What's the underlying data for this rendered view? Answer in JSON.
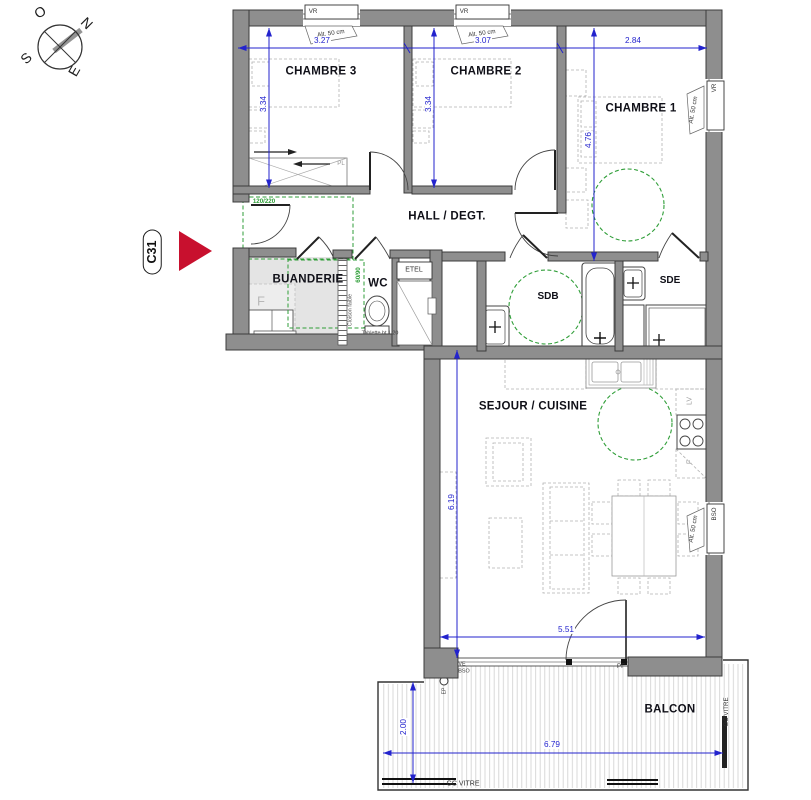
{
  "unit": {
    "label": "C31"
  },
  "compass": {
    "o": "O",
    "n": "N",
    "e": "E",
    "s": "S"
  },
  "rooms": {
    "chambre3": "CHAMBRE 3",
    "chambre2": "CHAMBRE 2",
    "chambre1": "CHAMBRE 1",
    "hall": "HALL / DEGT.",
    "buanderie": "BUANDERIE",
    "wc": "WC",
    "sdb": "SDB",
    "sde": "SDE",
    "sejour": "SEJOUR / CUISINE",
    "balcon": "BALCON"
  },
  "dimensions": {
    "chambre3_width": "3.27",
    "chambre2_width": "3.07",
    "chambre1_width": "2.84",
    "chambre3_depth": "3.34",
    "chambre2_depth": "3.34",
    "chambre1_depth": "4.76",
    "sejour_depth": "6.19",
    "sejour_width": "5.51",
    "balcon_depth": "2.00",
    "balcon_width": "6.79"
  },
  "openings": {
    "vr": "VR",
    "bso": "BSO",
    "alt_50": "Alt. 50 cm",
    "entry_door_size": "120/220",
    "wc_door_size": "60/90",
    "ve": "VE",
    "pf": "PF",
    "ep": "EP",
    "gc_vitre": "GC VITRE"
  },
  "annotations": {
    "pl": "PL",
    "etel": "ETEL",
    "cloison_faible": "Cloison faible",
    "tablette": "Tablette ht 1.20",
    "washer": "F",
    "lv": "LV",
    "oven": "F"
  },
  "colors": {
    "dimension_blue": "#2323cd",
    "clearance_green": "#2f9e38",
    "arrow_red": "#c8102e",
    "wall_gray": "#8e8e8e"
  }
}
